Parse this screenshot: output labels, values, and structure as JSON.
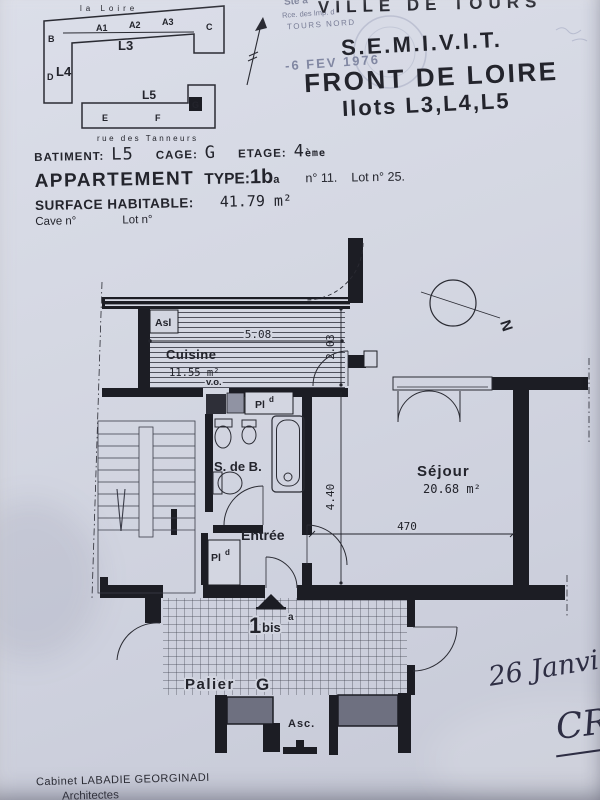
{
  "colors": {
    "paper": "#d3d6e1",
    "ink": "#1c1d24",
    "stamp": "#7e849f",
    "hand_ink": "#2e2e44",
    "elevator_fill": "#6e7080"
  },
  "header": {
    "stamp_line1": "Ste à",
    "stamp_line2": "Rce. des Imp. d",
    "stamp_line3": "TOURS NORD",
    "date_stamp": "-6 FEV 1976",
    "city": "VILLE DE TOURS",
    "org": "S.E.M.I.V.I.T.",
    "project": "FRONT DE LOIRE",
    "ilots": "Ilots L3,L4,L5"
  },
  "info": {
    "batiment_label": "BATIMENT:",
    "batiment_value": "L5",
    "cage_label": "CAGE:",
    "cage_value": "G",
    "etage_label": "ETAGE:",
    "etage_value": "4",
    "etage_sup": "ème",
    "appartement_label": "APPARTEMENT",
    "type_label": "TYPE:",
    "type_value": "1b",
    "type_sup": "a",
    "numero": "n° 11.",
    "lot": "Lot n° 25.",
    "surface_label": "SURFACE HABITABLE:",
    "surface_value": "41.79 m²",
    "cave_label": "Cave n°",
    "lot_label2": "Lot n°"
  },
  "site_plan": {
    "river": "la Loire",
    "street": "rue des Tanneurs",
    "l3": "L3",
    "l4": "L4",
    "l5": "L5",
    "a1": "A1",
    "a2": "A2",
    "a3": "A3",
    "b": "B",
    "c": "C",
    "d": "D",
    "e": "E",
    "f": "F",
    "g": "G"
  },
  "plan": {
    "north": "N",
    "rooms": {
      "cuisine": {
        "name": "Cuisine",
        "area": "11.55 m²"
      },
      "bathroom": {
        "name": "S. de B."
      },
      "entry": {
        "name": "Entrée"
      },
      "living": {
        "name": "Séjour",
        "area": "20.68 m²"
      },
      "landing": {
        "name": "Palier",
        "cage": "G"
      },
      "elevator": {
        "name": "Asc."
      }
    },
    "labels": {
      "asl": "Asl",
      "vo": "v.o.",
      "placard": "Pl",
      "placard_sup": "d",
      "unit_big": "1",
      "unit_small": "bis",
      "unit_sup": "a"
    },
    "dims": {
      "kitchen_width": "5.08",
      "kitchen_depth": "2.03",
      "living_depth": "4.40",
      "living_width": "470"
    }
  },
  "annotations": {
    "handwritten_date": "26 Janvier",
    "handwritten_initials": "CR"
  },
  "footer": {
    "office": "Cabinet LABADIE GEORGINADI",
    "title": "Architectes"
  }
}
